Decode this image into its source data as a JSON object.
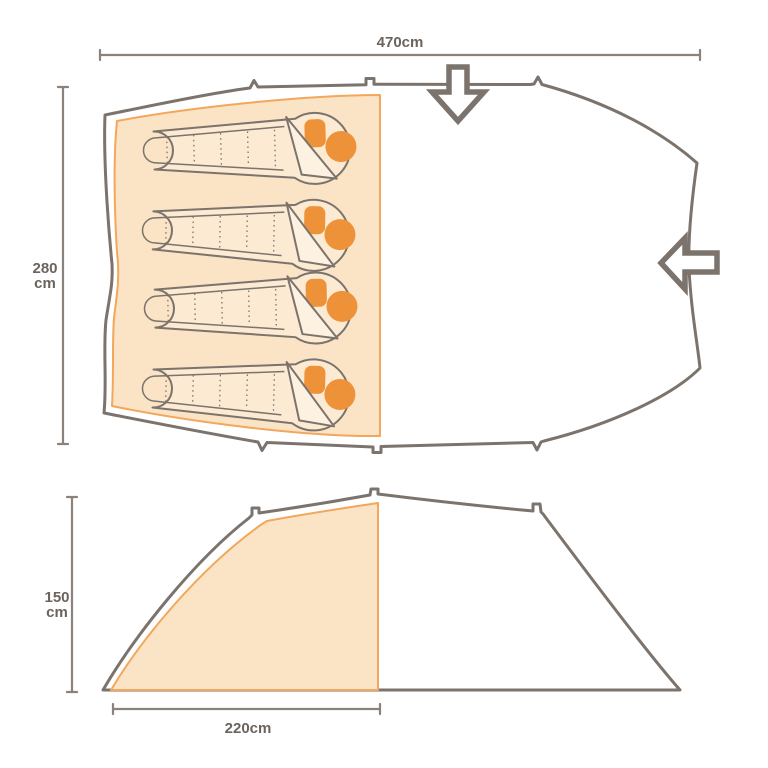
{
  "diagram": {
    "top_view": {
      "width_label": "470cm",
      "depth_value": "280",
      "depth_unit": "cm",
      "sleeping_bag_count": 4,
      "icons": {
        "front_entrance": "down-arrow",
        "side_entrance": "left-arrow"
      }
    },
    "side_view": {
      "height_value": "150",
      "height_unit": "cm",
      "bedroom_width_label": "220cm"
    },
    "colors": {
      "outline": "#7b736c",
      "dim_line": "#8a827b",
      "dim_text": "#6b635c",
      "sheet_fill": "#fbe3c6",
      "sheet_border": "#f2a75c",
      "accent": "#ee9239",
      "bag_fill": "#fcebd2",
      "flap_fill": "#fdf2e1",
      "background": "#ffffff"
    }
  }
}
